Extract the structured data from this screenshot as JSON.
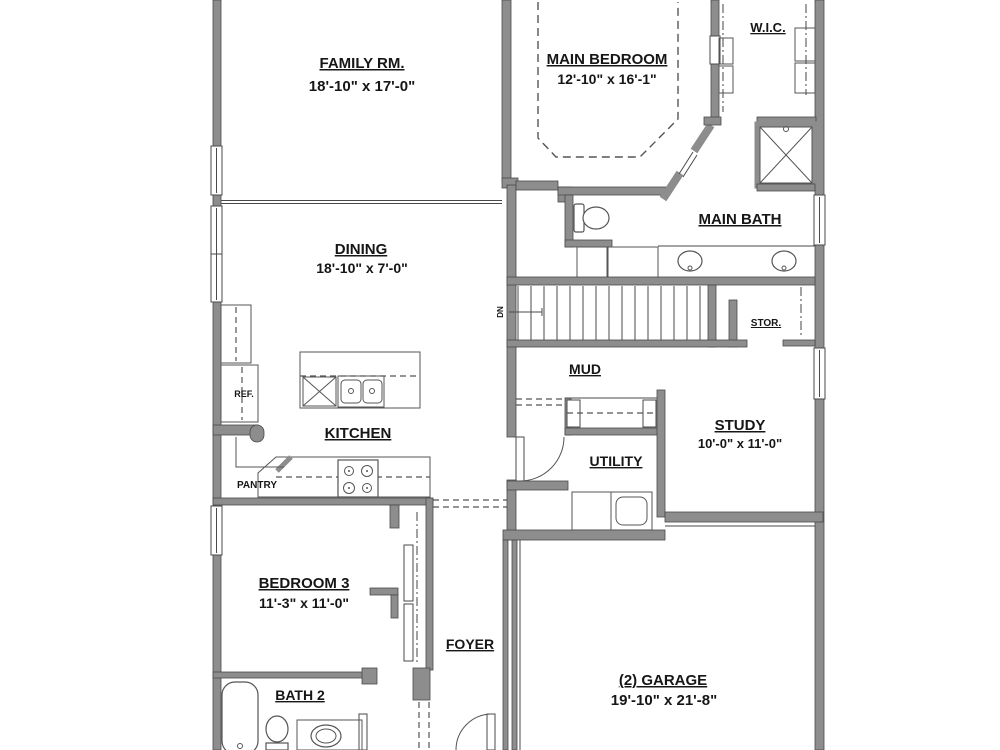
{
  "meta": {
    "drawing_type": "residential floor plan, partial view (cut off top and bottom)"
  },
  "colors": {
    "wall_fill": "#8d8d8d",
    "wall_edge": "#4a4a4a",
    "line": "#4a4a4a",
    "background": "#ffffff",
    "text": "#161616"
  },
  "rooms": {
    "family": {
      "name": "FAMILY RM.",
      "dims": "18'-10\" x 17'-0\""
    },
    "dining": {
      "name": "DINING",
      "dims": "18'-10\" x 7'-0\""
    },
    "kitchen": {
      "name": "KITCHEN"
    },
    "pantry": {
      "name": "PANTRY"
    },
    "main_bedroom": {
      "name": "MAIN BEDROOM",
      "dims": "12'-10\" x 16'-1\""
    },
    "wic": {
      "name": "W.I.C."
    },
    "main_bath": {
      "name": "MAIN BATH"
    },
    "stor": {
      "name": "STOR."
    },
    "mud": {
      "name": "MUD"
    },
    "utility": {
      "name": "UTILITY"
    },
    "study": {
      "name": "STUDY",
      "dims": "10'-0\" x 11'-0\""
    },
    "bedroom3": {
      "name": "BEDROOM 3",
      "dims": "11'-3\" x 11'-0\""
    },
    "foyer": {
      "name": "FOYER"
    },
    "bath2": {
      "name": "BATH 2"
    },
    "garage": {
      "name": "(2) GARAGE",
      "dims": "19'-10\" x 21'-8\""
    }
  },
  "labels": {
    "refrigerator": "REF.",
    "stairs_direction": "DN"
  }
}
